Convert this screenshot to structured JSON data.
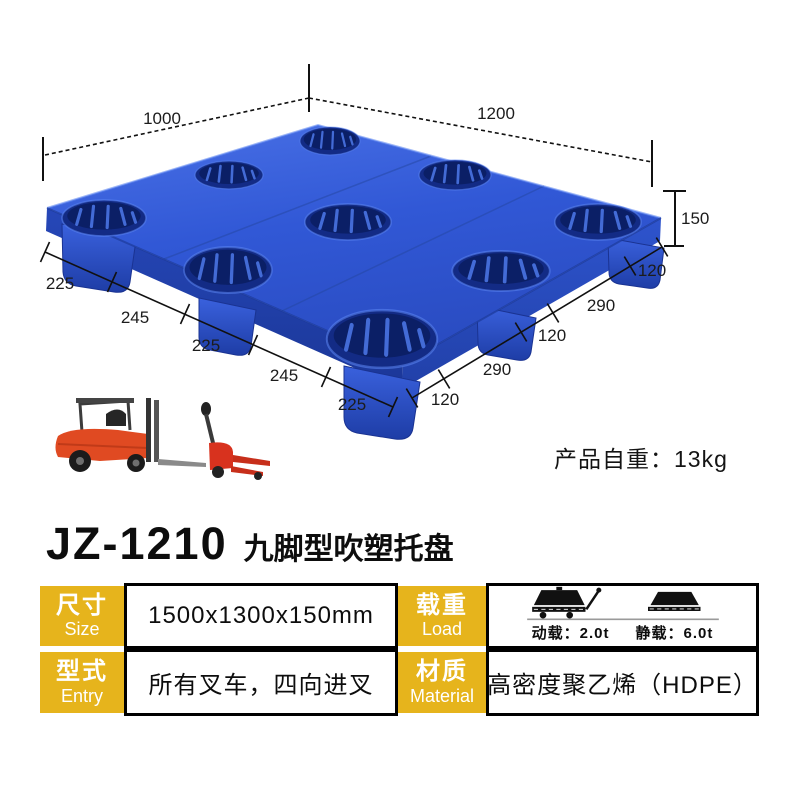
{
  "product_diagram": {
    "dimensions": {
      "top_width": "1000",
      "top_length": "1200",
      "height": "150",
      "left_segments": [
        "225",
        "245",
        "225",
        "245",
        "225"
      ],
      "right_segments": [
        "120",
        "290",
        "120",
        "290",
        "120"
      ]
    },
    "weight_note": "产品自重：13kg"
  },
  "header": {
    "model": "JZ-1210",
    "product_name": "九脚型吹塑托盘"
  },
  "spec_table": {
    "size": {
      "label_cn": "尺寸",
      "label_en": "Size",
      "value": "1500x1300x150mm"
    },
    "load": {
      "label_cn": "载重",
      "label_en": "Load",
      "dynamic_load": "动载：2.0t",
      "static_load": "静载：6.0t"
    },
    "entry": {
      "label_cn": "型式",
      "label_en": "Entry",
      "value": "所有叉车，四向进叉"
    },
    "material": {
      "label_cn": "材质",
      "label_en": "Material",
      "value": "高密度聚乙烯（HDPE）"
    }
  },
  "colors": {
    "accent_yellow": "#E6B41C",
    "pallet_blue": "#2F55CE",
    "text_black": "#111111"
  }
}
